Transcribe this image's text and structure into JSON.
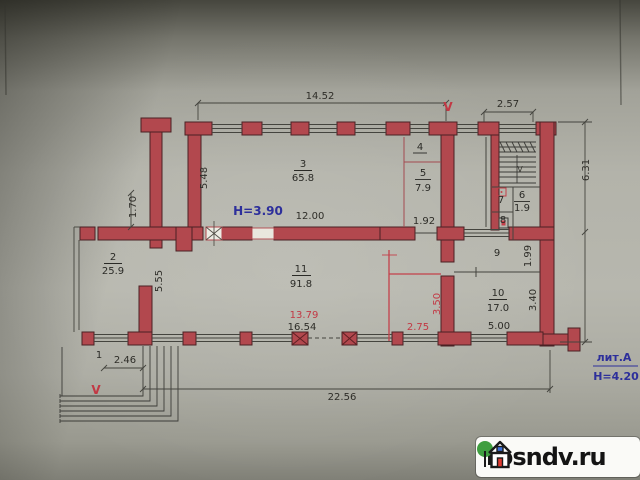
{
  "plan": {
    "rooms": {
      "r1": {
        "num": "1"
      },
      "r2": {
        "num": "2",
        "area": "25.9"
      },
      "r3": {
        "num": "3",
        "area": "65.8"
      },
      "r4": {
        "num": "4"
      },
      "r5": {
        "num": "5",
        "area": "7.9"
      },
      "r6": {
        "num": "6",
        "area": "1.9"
      },
      "r7": {
        "num": "7"
      },
      "r8": {
        "num": "8"
      },
      "r9": {
        "num": "9"
      },
      "r10": {
        "num": "10",
        "area": "17.0"
      },
      "r11": {
        "num": "11",
        "area": "91.8"
      }
    },
    "dims": {
      "top": "14.52",
      "stair_top": "2.57",
      "right_side": "6.31",
      "room3_height": "5.48",
      "left_offset": "1.70",
      "hall_width": "12.00",
      "room5_width": "1.92",
      "room2_height": "5.55",
      "room9_height": "1.99",
      "room10_height": "3.40",
      "room10_width": "5.00",
      "porch_width": "2.46",
      "bottom_total": "22.56",
      "red_inner_width": "13.79",
      "inner_width": "16.54",
      "red_corridor_width": "2.75",
      "red_corridor_height": "3.50"
    },
    "notes": {
      "ceiling_height_main": "H=3.90",
      "litera": "лит.А",
      "ceiling_height_lower": "H=4.20",
      "vent_mark_top": "V",
      "vent_mark_bottom": "V",
      "stair_direction": "V"
    }
  },
  "watermark": {
    "site": "rosndv.ru"
  }
}
